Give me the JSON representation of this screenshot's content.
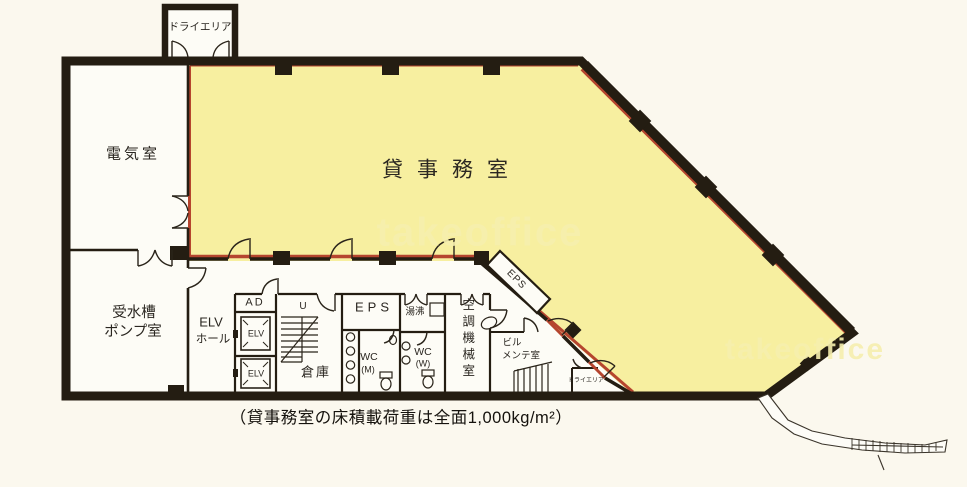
{
  "plan": {
    "rooms": {
      "dry_area_top": "ドライエリア",
      "electrical": "電気室",
      "office": "貸事務室",
      "tank_pump_l1": "受水槽",
      "tank_pump_l2": "ポンプ室",
      "elv_hall_l1": "ELV",
      "elv_hall_l2": "ホール",
      "ad": "AD",
      "elv_1": "ELV",
      "elv_2": "ELV",
      "stair_up": "U",
      "storage": "倉庫",
      "eps": "EPS",
      "eps_diag": "EPS",
      "hot_water": "湯沸",
      "wc_m_l1": "WC",
      "wc_m_l2": "(M)",
      "wc_w_l1": "WC",
      "wc_w_l2": "(W)",
      "hvac": "空調機械室",
      "maintenance_l1": "ビル",
      "maintenance_l2": "メンテ室",
      "dry_area_bottom": "ドライエリア"
    },
    "caption": "（貸事務室の床積載荷重は全面1,000kg/m²）",
    "watermark": "takeoffice",
    "colors": {
      "office_fill": "#f7efa0",
      "wall": "#241d12",
      "window_line": "#b5452e",
      "paper": "#fbf8ee",
      "room_fill": "#fdfcf6"
    }
  }
}
